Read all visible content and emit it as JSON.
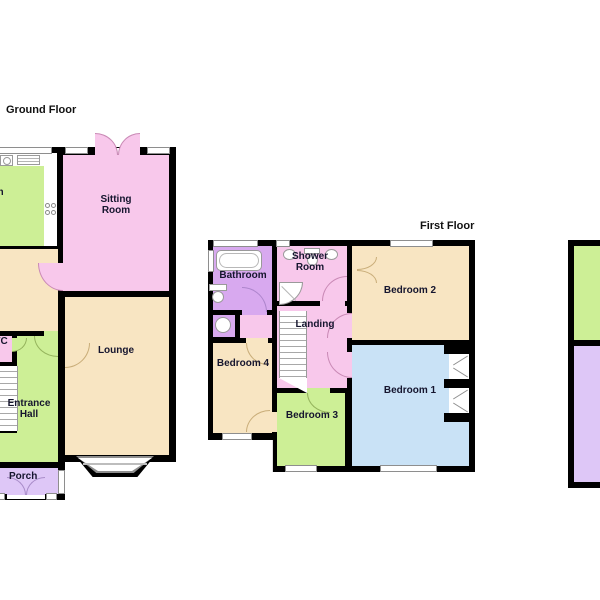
{
  "plans": {
    "ground": {
      "title": "Ground Floor",
      "rooms": {
        "kitchen": "Kitchen",
        "sitting": "Sitting Room",
        "lounge": "Lounge",
        "hall": "Entrance Hall",
        "wc": "WC",
        "porch": "Porch"
      }
    },
    "first": {
      "title": "First Floor",
      "rooms": {
        "bathroom": "Bathroom",
        "shower": "Shower Room",
        "landing": "Landing",
        "bed1": "Bedroom 1",
        "bed2": "Bedroom 2",
        "bed3": "Bedroom 3",
        "bed4": "Bedroom 4"
      }
    },
    "second_partial": {
      "title": "",
      "note_rooms_unlabeled": true
    }
  },
  "colors": {
    "wall": "#000000",
    "pink_room": "#f8c8eb",
    "green_room": "#cdef96",
    "tan_room": "#f8e5c2",
    "blue_room": "#c9e2f6",
    "bathroom_purple": "#d8a9ef",
    "porch_purple": "#dec7f7",
    "window_frame": "#8e8e8e",
    "background": "#ffffff",
    "label_text": "#15152e"
  },
  "fixtures": {
    "bathtub": "css-shape",
    "toilet": "css-shape",
    "wash-basin": "css-shape",
    "corner-shower": "css-shape",
    "hob": "css-shape",
    "washing-machine": "css-shape",
    "draining-board": "css-shape",
    "stairs": "css-shape",
    "bay-window": "css-shape",
    "wardrobe": "css-shape"
  }
}
